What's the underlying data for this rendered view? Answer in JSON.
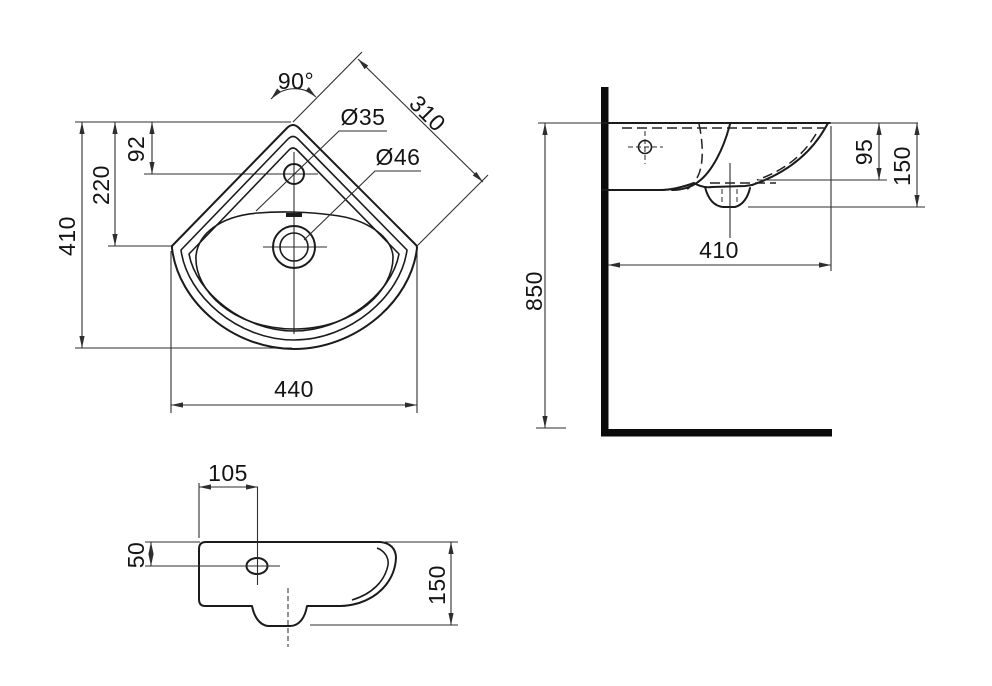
{
  "drawing_type": "corner-basin-technical-drawing",
  "colors": {
    "background": "#ffffff",
    "object_line": "#1b1b1b",
    "dimension_line": "#2e2e2e",
    "text": "#141414",
    "wall_fill": "#0b0b0b"
  },
  "plan_view": {
    "corner_angle": "90°",
    "edge_width": "310",
    "tap_hole_diameter": "Ø35",
    "drain_diameter": "Ø46",
    "tap_depth": "92",
    "drain_depth": "220",
    "overall_depth": "410",
    "overall_width": "440"
  },
  "side_view": {
    "mounting_height": "850",
    "basin_depth": "410",
    "rim_drop": "95",
    "apron_height": "150"
  },
  "front_view": {
    "tap_offset": "105",
    "tap_drop": "50",
    "apron_height": "150"
  }
}
